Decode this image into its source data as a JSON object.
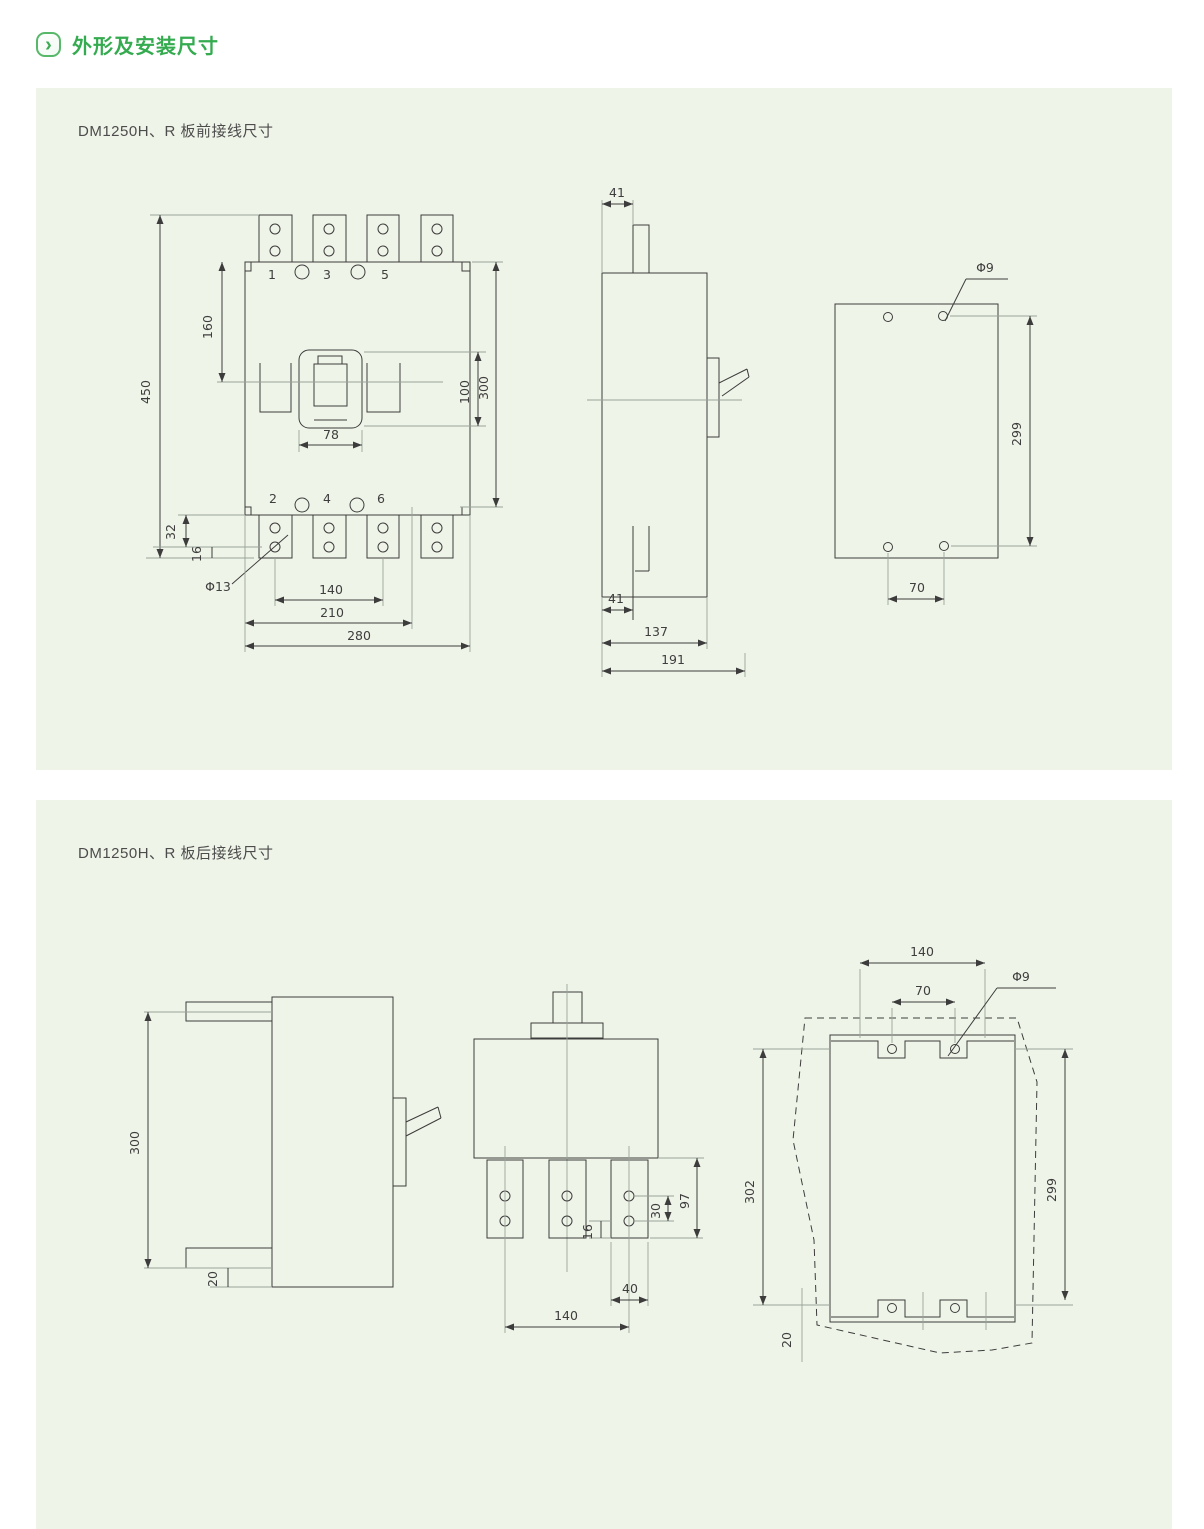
{
  "header": {
    "title": "外形及安装尺寸",
    "icon_glyph": "›",
    "accent_color": "#35ab50",
    "panel_color": "#eff4e8"
  },
  "panel_front": {
    "title": "DM1250H、R 板前接线尺寸",
    "front_view": {
      "terminals": {
        "t1": "1",
        "t3": "3",
        "t5": "5",
        "t2": "2",
        "t4": "4",
        "t6": "6"
      },
      "dims": {
        "total_height": "450",
        "top_to_center": "160",
        "cover_height": "100",
        "body_height": "300",
        "cover_width": "78",
        "lug_drop": "32",
        "lug_thickness": "16",
        "lug_hole": "Φ13",
        "pole_span": "140",
        "mount_width": "210",
        "body_width": "280"
      }
    },
    "side_view": {
      "dims": {
        "lug_top": "41",
        "lug_bottom": "41",
        "body_depth": "137",
        "total_depth": "191"
      }
    },
    "drill_view": {
      "dims": {
        "hole": "Φ9",
        "vertical_pitch": "299",
        "horizontal_pitch": "70"
      }
    }
  },
  "panel_rear": {
    "title": "DM1250H、R 板后接线尺寸",
    "side_view": {
      "dims": {
        "stud_pitch": "300",
        "stud_offset": "20"
      }
    },
    "rear_view": {
      "dims": {
        "hole_pitch": "30",
        "strap_thickness": "16",
        "strap_length": "97",
        "strap_width": "40",
        "pole_span": "140"
      }
    },
    "drill_view": {
      "dims": {
        "slot_span": "140",
        "hole_pitch": "70",
        "hole": "Φ9",
        "left_height": "302",
        "right_height": "299",
        "bottom_offset": "20"
      }
    }
  }
}
